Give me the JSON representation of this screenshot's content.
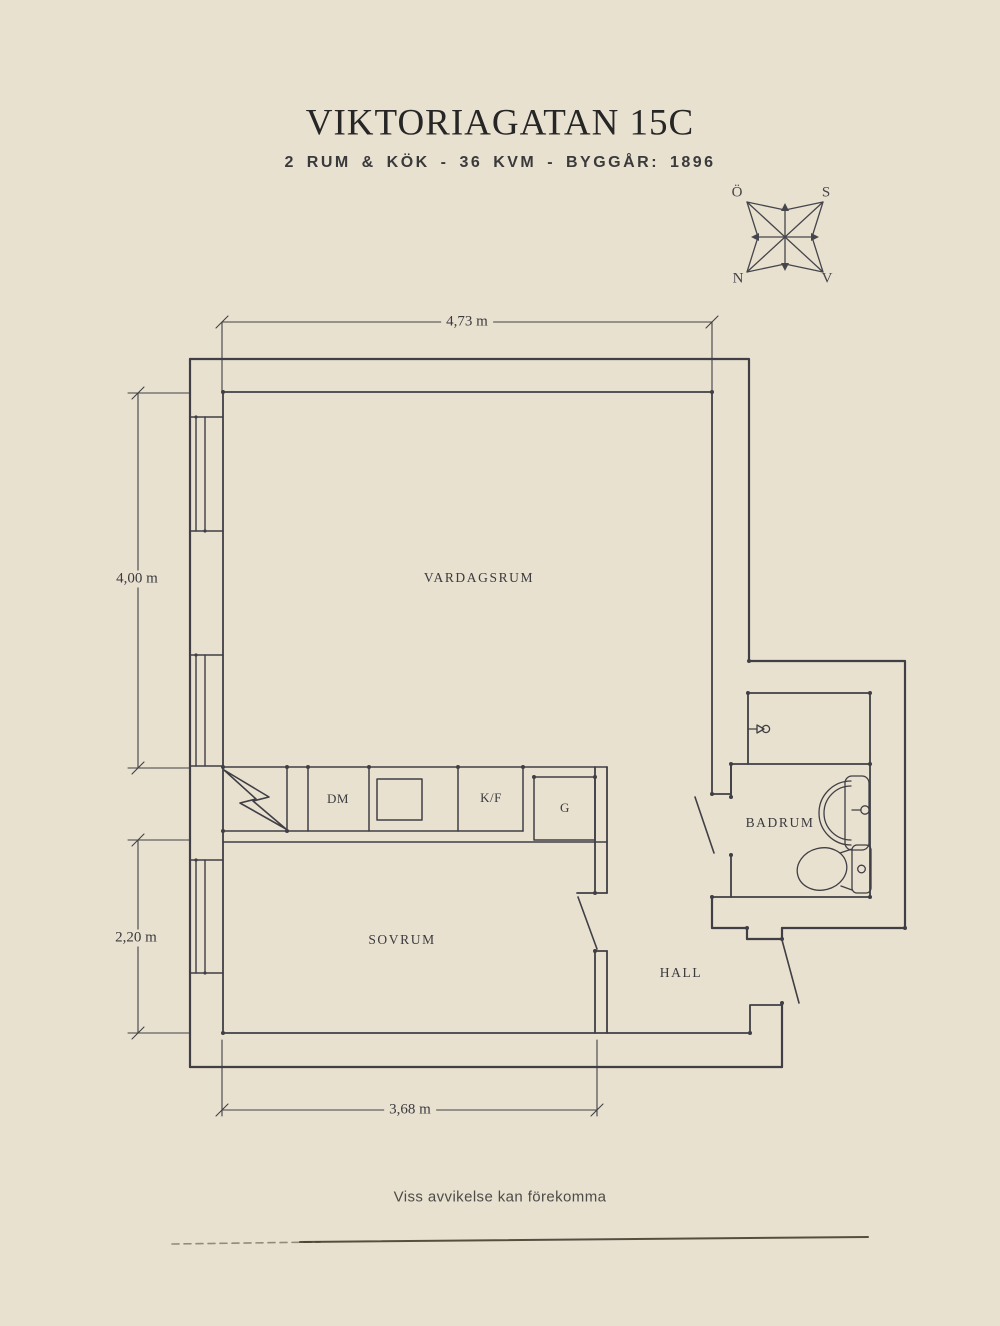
{
  "header": {
    "title": "VIKTORIAGATAN 15C",
    "subtitle": "2 RUM & KÖK - 36 KVM - BYGGÅR: 1896"
  },
  "compass": {
    "east": "Ö",
    "south": "S",
    "north": "N",
    "west": "V"
  },
  "rooms": {
    "living": "VARDAGSRUM",
    "bedroom": "SOVRUM",
    "hall": "HALL",
    "bathroom": "BADRUM"
  },
  "kitchen_units": {
    "dishwasher": "DM",
    "fridge_freezer": "K/F",
    "wardrobe": "G"
  },
  "dimensions": {
    "top_width": "4,73 m",
    "left_upper_height": "4,00 m",
    "left_lower_height": "2,20 m",
    "bottom_width": "3,68 m"
  },
  "footer": {
    "disclaimer": "Viss avvikelse kan förekomma"
  },
  "colors": {
    "background": "#e9e1d0",
    "ink": "#3f3f45",
    "title_ink": "#262626"
  }
}
